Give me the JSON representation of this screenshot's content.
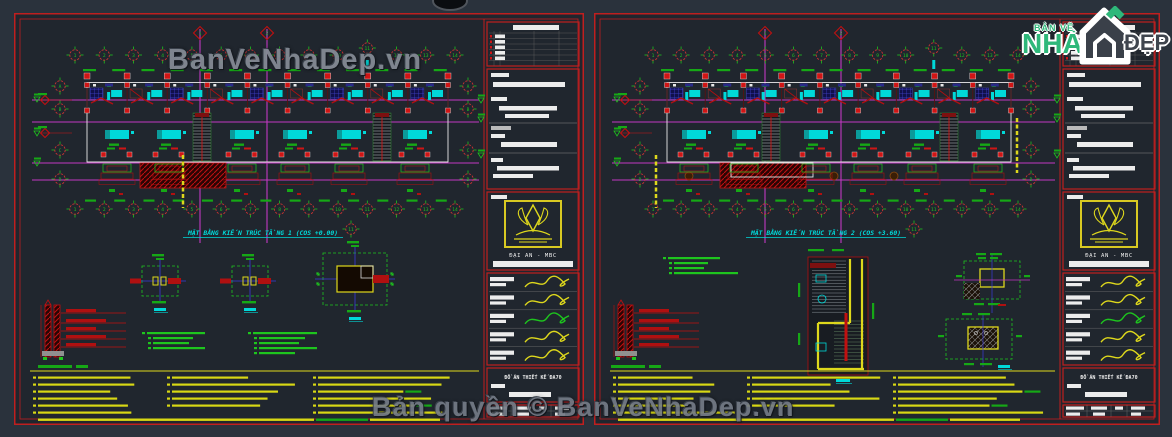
{
  "colors": {
    "bg": "#2a323c",
    "sheet": "#20262e",
    "border": "#c01f1f",
    "red": "#d01515",
    "darkred": "#7d1010",
    "magenta": "#c238c2",
    "green": "#1ec51e",
    "dimgreen": "#16a816",
    "cyan": "#00d9d9",
    "yellow": "#ded81c",
    "notes_yellow": "#d8d814",
    "white": "#ececec",
    "gray": "#8a9097",
    "blue": "#3b3bd8",
    "brand_green": "#2eb87a",
    "watermark": "#868d97"
  },
  "watermarks": {
    "top": "BanVeNhaDep.vn",
    "bottom": "Bản quyền © BanVeNhaDep.vn"
  },
  "brand": {
    "line1": "BẢN VẼ",
    "line2": "NHÀ",
    "line3": "ĐẸP"
  },
  "title_block": {
    "company": "ĐẠI AN - MBC",
    "doc_title": "ĐỒ ÁN THIẾT KẾ ĐA70"
  },
  "sheets": [
    {
      "id": "tang-1",
      "title": "MẶT BẰNG KIẾN TRÚC TẦNG 1 (COS +0.00)",
      "grid_cols": [
        "1",
        "2",
        "3",
        "4",
        "5",
        "6",
        "7",
        "8",
        "9",
        "10",
        "11",
        "12",
        "13",
        "14"
      ],
      "grid_rows": [
        "A",
        "B",
        "C",
        "D"
      ],
      "section_marks": [
        "1",
        "2"
      ],
      "axis_note": "11"
    },
    {
      "id": "tang-2",
      "title": "MẶT BẰNG KIẾN TRÚC TẦNG 2 (COS +3.60)",
      "grid_cols": [
        "1",
        "2",
        "3",
        "4",
        "5",
        "6",
        "7",
        "8",
        "9",
        "10",
        "11",
        "12",
        "13",
        "14"
      ],
      "grid_rows": [
        "A",
        "B",
        "C",
        "D"
      ],
      "section_marks": [
        "1",
        "2"
      ],
      "axis_note": "11"
    }
  ]
}
